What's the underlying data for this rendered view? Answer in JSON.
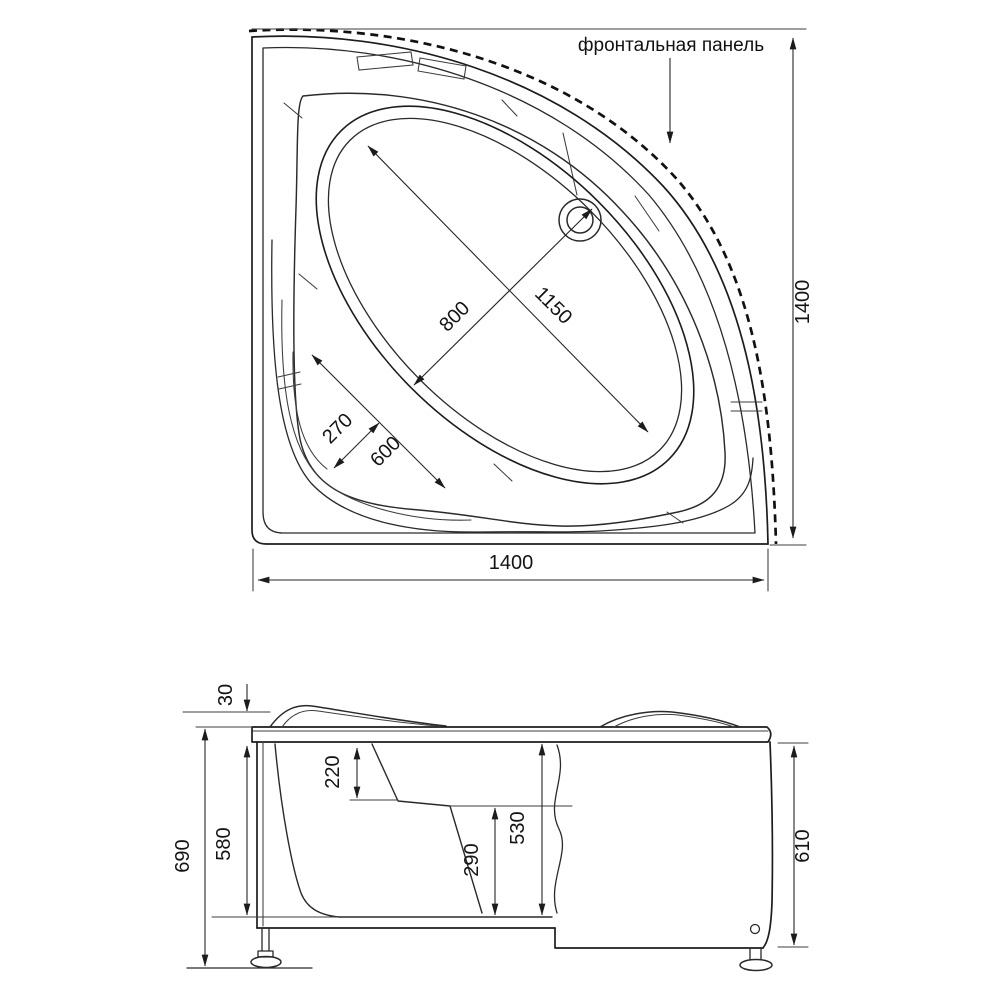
{
  "panel_callout_label": "фронтальная панель",
  "top_view": {
    "basin_width": "800",
    "basin_length": "1150",
    "seat_width": "270",
    "seat_depth": "600",
    "overall_width": "1400",
    "overall_depth": "1400"
  },
  "side_view": {
    "rim_lip_height": "30",
    "rim_to_seat_depth": "220",
    "shell_height": "580",
    "overall_height": "690",
    "seat_to_bottom_height": "290",
    "inner_depth": "530",
    "panel_height": "610"
  }
}
